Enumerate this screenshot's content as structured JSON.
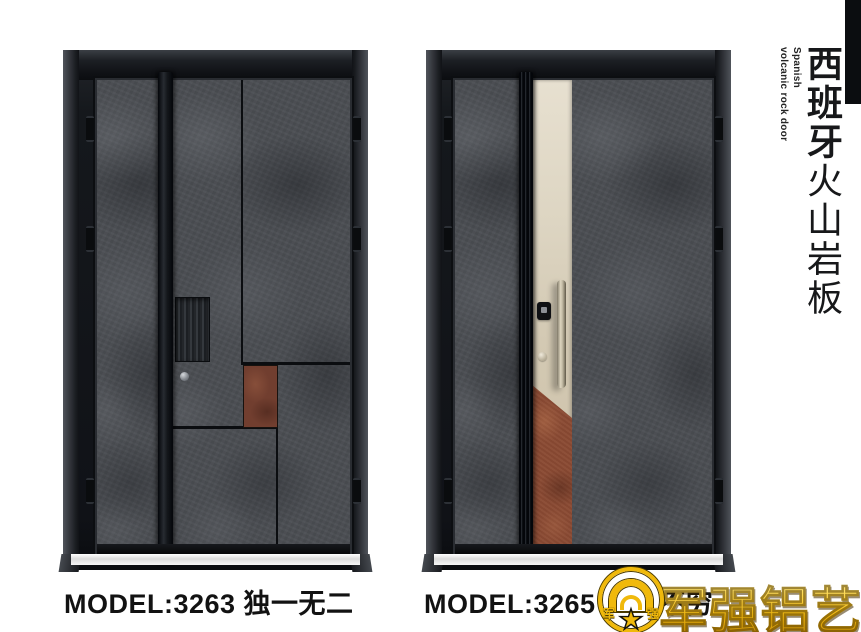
{
  "side_panel": {
    "title_bold": "西班牙",
    "title_light": "火山岩板",
    "subtitle_line1": "Spanish",
    "subtitle_line2": "volcanic rock door"
  },
  "doors": [
    {
      "model": "MODEL:3263  独一无二"
    },
    {
      "model": "MODEL:3265  层出不穷"
    }
  ],
  "brand": {
    "name": "军强铝艺",
    "emblem_char_left": "军",
    "emblem_char_right": "强",
    "gold": "#f0b90b"
  },
  "colors": {
    "rock": "#4b4e53",
    "rust_left": "#713e2f",
    "rust_right": "#8a4a33",
    "champagne": "#ddd5c2",
    "frame": "#14161a"
  }
}
